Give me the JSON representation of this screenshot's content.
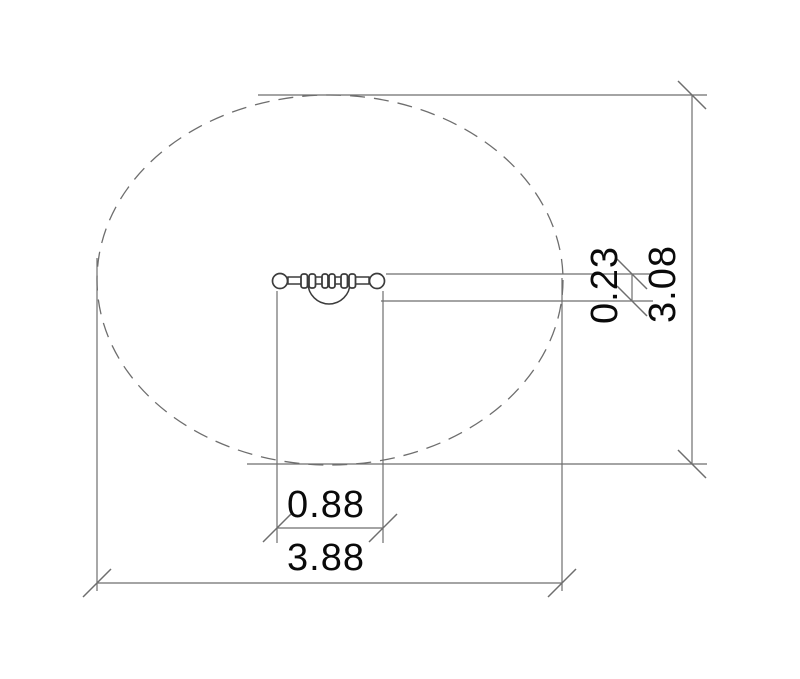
{
  "drawing": {
    "kind": "technical-dimension-drawing",
    "view": "plan-view",
    "background_color": "#ffffff",
    "line_color": "#6e6e6e",
    "object_line_color": "#3c3c3c",
    "text_color": "#0a0a0a",
    "clearance_zone": {
      "shape": "dashed-ellipse",
      "width_units": 3.88,
      "height_units": 3.08
    },
    "dimensions": {
      "inner_width": "0.88",
      "overall_width": "3.88",
      "bar_depth": "0.23",
      "overall_height": "3.08"
    }
  }
}
